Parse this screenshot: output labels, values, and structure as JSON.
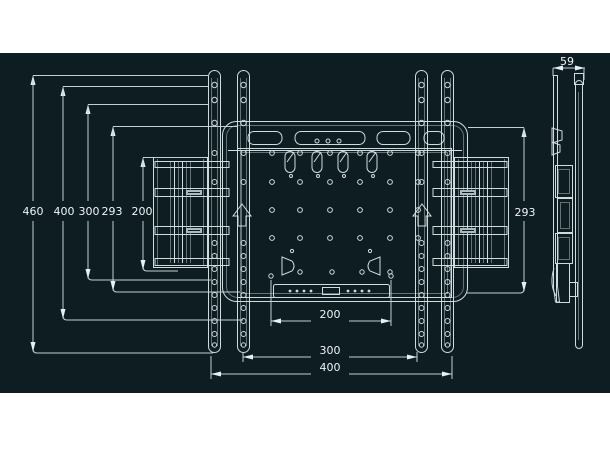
{
  "drawing": {
    "dims": {
      "left": [
        "460",
        "400",
        "300",
        "293",
        "200"
      ],
      "bottom": [
        "200",
        "300",
        "400"
      ],
      "right_height": "293",
      "side_depth": "59"
    },
    "colors": {
      "page_background": "#ffffff",
      "panel_background": "#0e1d22",
      "line": "#cfdbdd",
      "text": "#eef4f5"
    }
  }
}
